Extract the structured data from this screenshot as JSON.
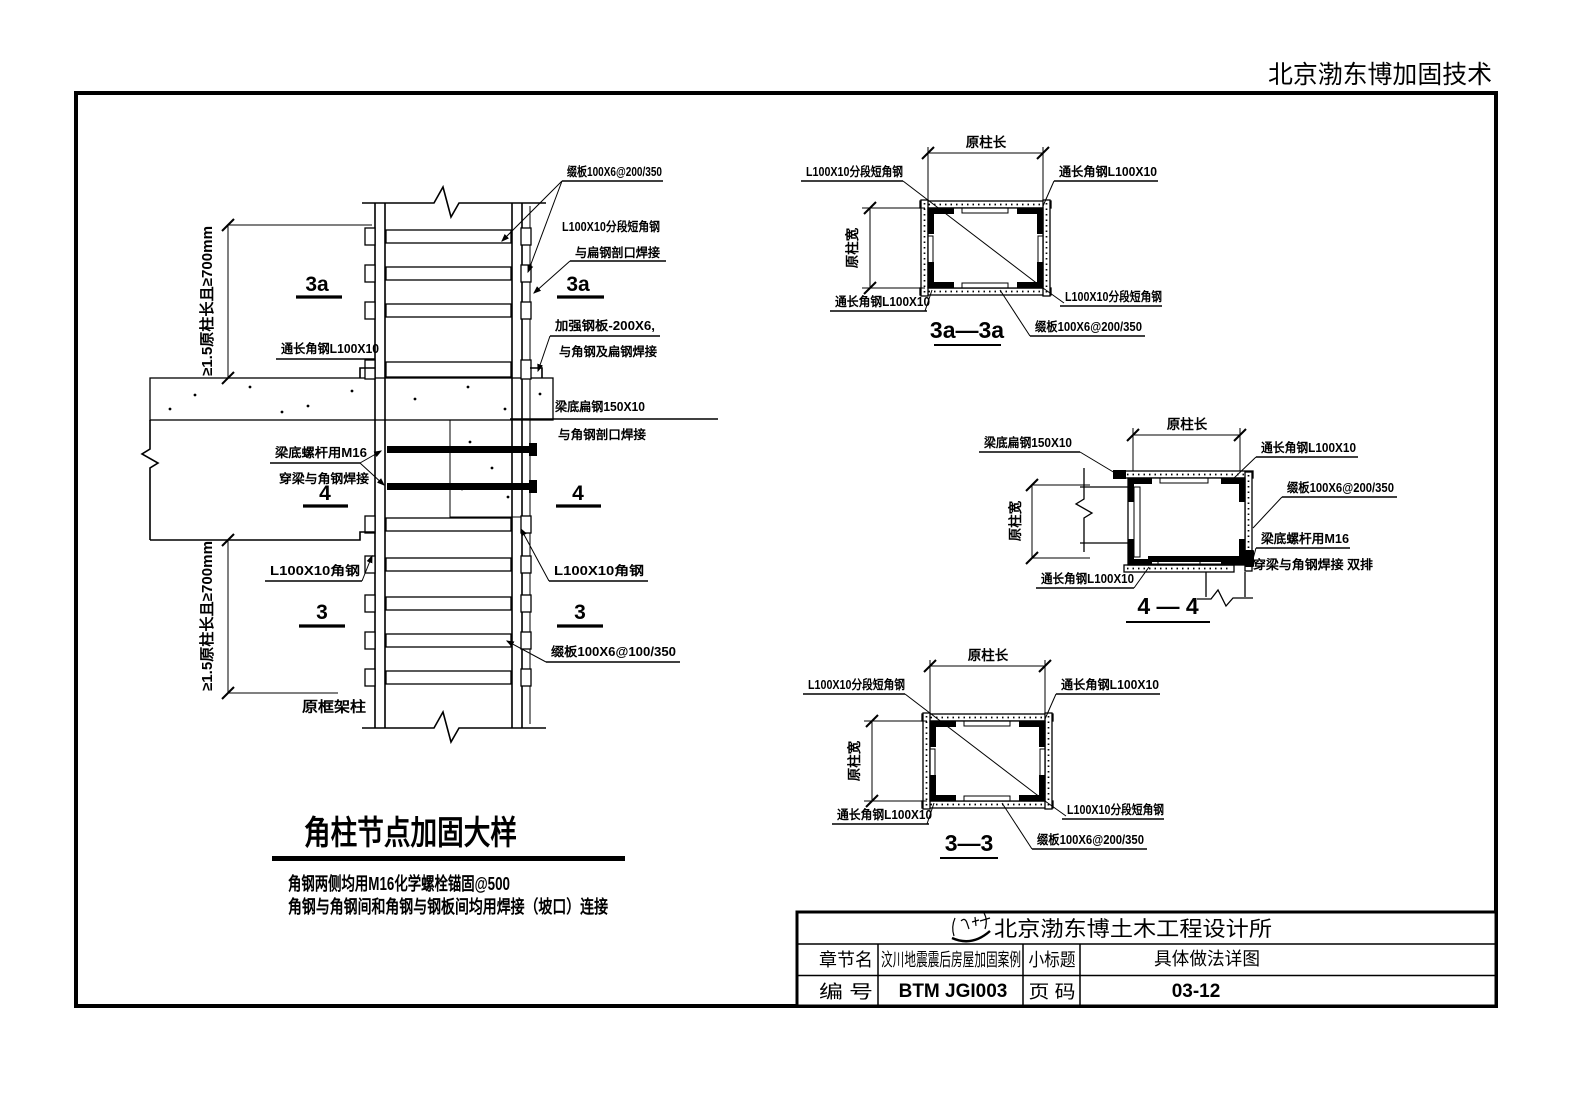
{
  "header": {
    "brand": "北京渤东博加固技术"
  },
  "drawing": {
    "title": "角柱节点加固大样",
    "note1": "角钢两侧均用M16化学螺栓锚固@500",
    "note2": "角钢与角钢间和角钢与钢板间均用焊接（坡口）连接",
    "dim_column": "≥1.5原柱长且≥700mm",
    "labels": {
      "batten_200": "缀板100X6@200/350",
      "batten_100": "缀板100X6@100/350",
      "seg_angle": "L100X10分段短角钢",
      "seg_angle_weld": "与扁钢剖口焊接",
      "cont_angle": "通长角钢L100X10",
      "strengthen_plate": "加强钢板-200X6,",
      "strengthen_weld": "与角钢及扁钢焊接",
      "beam_flat": "梁底扁钢150X10",
      "beam_flat_weld": "与角钢剖口焊接",
      "bolt": "梁底螺杆用M16",
      "bolt_weld": "穿梁与角钢焊接",
      "bolt_weld_rows": "穿梁与角钢焊接 双排",
      "angle": "L100X10角钢",
      "orig_column": "原框架柱",
      "dim_len": "原柱长",
      "dim_wid": "原柱宽"
    },
    "markers": {
      "s3a": "3a",
      "s4": "4",
      "s3": "3"
    },
    "sections": {
      "t3a": "3a—3a",
      "t4": "4 — 4",
      "t3": "3—3"
    }
  },
  "titleblock": {
    "company": "北京渤东博土木工程设计所",
    "chapter_label": "章节名",
    "chapter_value": "汶川地震震后房屋加固案例",
    "subtitle_label": "小标题",
    "subtitle_value": "具体做法详图",
    "number_label": "编  号",
    "number_value": "BTM JGI003",
    "page_label": "页  码",
    "page_value": "03-12"
  }
}
